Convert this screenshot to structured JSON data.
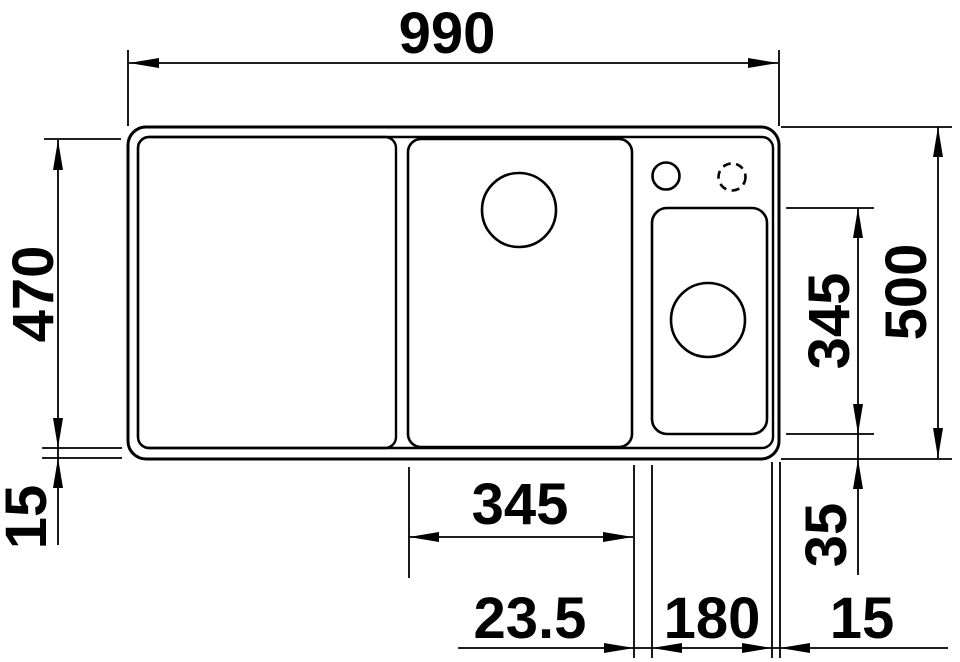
{
  "drawing": {
    "type": "sink-top-view-technical-drawing",
    "colors": {
      "background": "#ffffff",
      "line": "#000000"
    },
    "labels": {
      "overall_width": "990",
      "inner_depth": "470",
      "overall_depth": "500",
      "main_bowl_width": "345",
      "accessory_bowl_depth": "345",
      "bottom_rim": "15",
      "accessory_bowl_offset": "35",
      "divider_width": "23.5",
      "accessory_bowl_width": "180",
      "side_rim": "15"
    },
    "features": {
      "drainboard": "left drainboard area",
      "main_bowl": "centre bowl with drain hole",
      "accessory_bowl": "right half bowl with drain hole",
      "tap_hole": "pre-drilled tap hole",
      "tap_hole_optional": "optional tap hole (dashed)"
    }
  }
}
